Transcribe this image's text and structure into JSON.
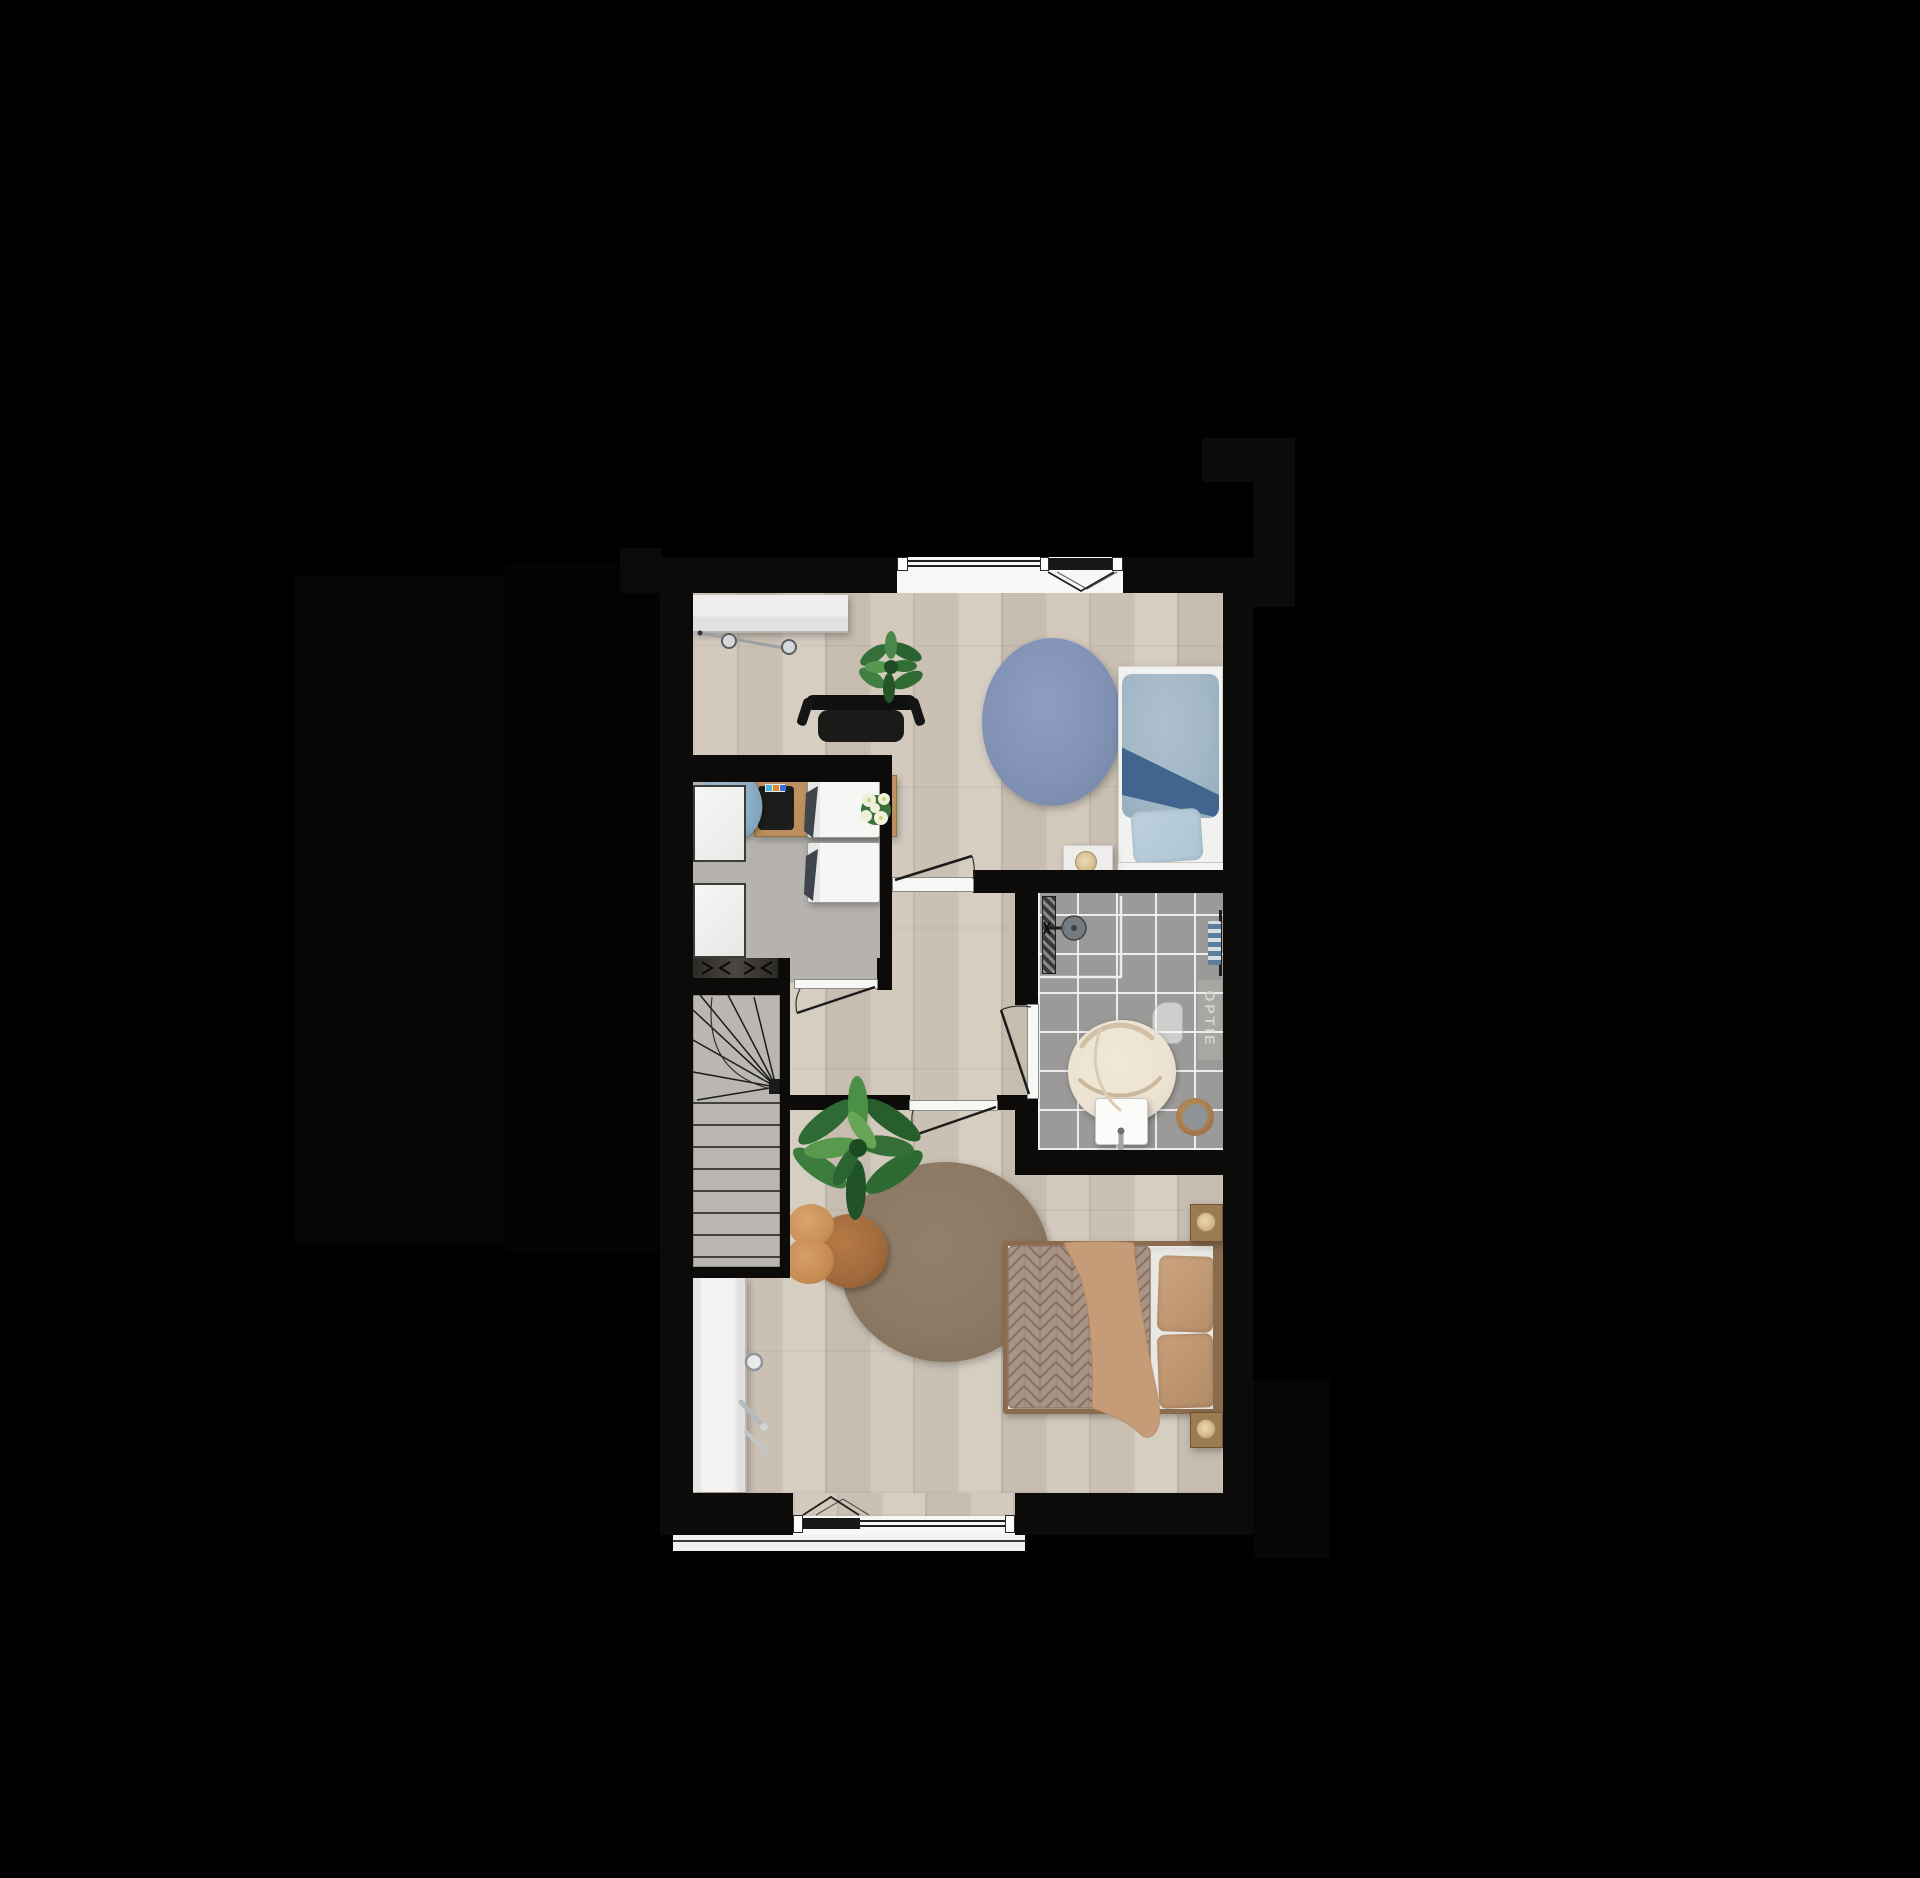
{
  "floorplan": {
    "bathroom": {
      "option_label": "OPTIE"
    },
    "colors": {
      "background": "#000000",
      "wall": "#0c0b0a",
      "wood_floor": "#cfc5b8",
      "closet_floor": "#b6b3af",
      "stair_floor": "#bab7b3",
      "bathroom_tile": "#9c9a98",
      "window_frame": "#f7f7f5",
      "blue_rug": "#8292b6",
      "blue_duvet": "#a3b8c6",
      "blue_accent": "#40658f",
      "brown_rug": "#8c7963",
      "tan_duvet": "#c69b77",
      "herringbone_blanket": "#a89384",
      "desk_wood": "#b98e5b",
      "plant_green": "#3b7a3e",
      "pouf_orange": "#c98f58"
    }
  }
}
